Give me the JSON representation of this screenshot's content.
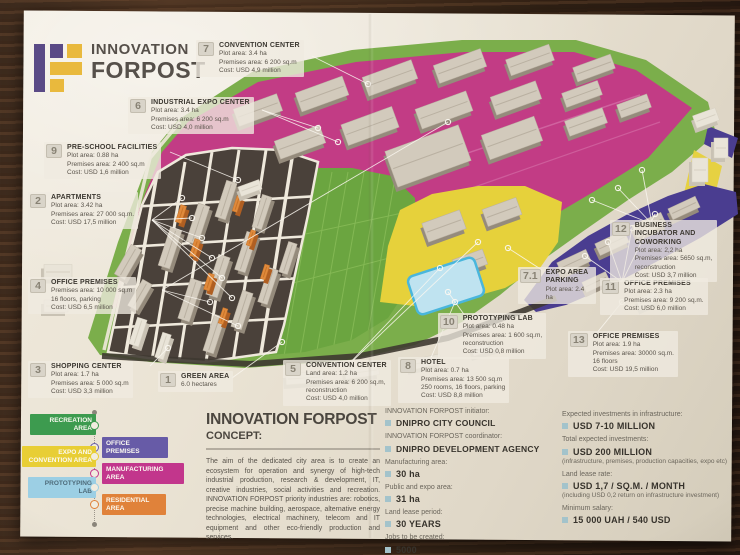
{
  "brand": {
    "line1": "INNOVATION",
    "line2": "FORPOST"
  },
  "map": {
    "labels": [
      {
        "num": "7",
        "title": "CONVENTION CENTER",
        "lines": [
          "Plot area: 3.4 ha",
          "Premises area: 6 200 sq.m",
          "Cost: USD 4,9 million"
        ]
      },
      {
        "num": "6",
        "title": "INDUSTRIAL EXPO CENTER",
        "lines": [
          "Plot area: 3.4 ha",
          "Premises area: 6 200 sq.m",
          "Cost: USD 4,0 million"
        ]
      },
      {
        "num": "9",
        "title": "PRE-SCHOOL FACILITIES",
        "lines": [
          "Plot area: 0.88 ha",
          "Premises area: 2 400 sq.m",
          "Cost: USD 1,6 million"
        ]
      },
      {
        "num": "2",
        "title": "APARTMENTS",
        "lines": [
          "Plot area: 3.42 ha",
          "Premises area: 27 000 sq.m.",
          "Cost: USD 17,5 million"
        ]
      },
      {
        "num": "4",
        "title": "OFFICE PREMISES",
        "lines": [
          "Premises area: 10 000 sq.m",
          "16 floors, parking",
          "Cost: USD 6,5 million"
        ]
      },
      {
        "num": "3",
        "title": "SHOPPING CENTER",
        "lines": [
          "Plot area: 1.7 ha",
          "Premises area: 5 000 sq.m",
          "Cost: USD 3,3 million"
        ]
      },
      {
        "num": "1",
        "title": "GREEN AREA",
        "lines": [
          "6.0 hectares"
        ]
      },
      {
        "num": "5",
        "title": "CONVENTION CENTER",
        "lines": [
          "Land area: 1.2 ha",
          "Premises area: 6 200 sq.m,",
          "reconstruction",
          "Cost: USD 4,0 million"
        ]
      },
      {
        "num": "8",
        "title": "HOTEL",
        "lines": [
          "Plot area: 0.7 ha",
          "Premises area: 13 500 sq.m",
          "250 rooms, 16 floors, parking",
          "Cost: USD 8,8 million"
        ]
      },
      {
        "num": "10",
        "title": "PROTOTYPING LAB",
        "lines": [
          "Plot area: 0.48 ha",
          "Premises area: 1 600 sq.m,",
          "reconstruction",
          "Cost: USD 0,8 million"
        ]
      },
      {
        "num": "7.1",
        "title": "EXPO AREA PARKING",
        "lines": [
          "Plot area: 2.4 ha"
        ]
      },
      {
        "num": "11",
        "title": "OFFICE PREMISES",
        "lines": [
          "Plot area: 2.3 ha",
          "Premises area: 9 200 sq.m.",
          "Cost: USD 6,0 million"
        ]
      },
      {
        "num": "12",
        "title": "BUSINESS INCUBATOR AND COWORKING",
        "lines": [
          "Plot area: 2,2 ha",
          "Premises area: 5650 sq.m,",
          "reconstruction",
          "Cost: USD 3,7 million"
        ]
      },
      {
        "num": "13",
        "title": "OFFICE PREMISES",
        "lines": [
          "Plot area: 1.9 ha",
          "Premises area: 30000 sq.m.",
          "16 floors",
          "Cost: USD 19,5 million"
        ]
      }
    ]
  },
  "legend": {
    "items": [
      {
        "label": "RECREATION AREA",
        "color": "#3d9b4f"
      },
      {
        "label": "OFFICE PREMISES",
        "color": "#675ba7"
      },
      {
        "label": "EXPO AND CONVENTION AREA",
        "color": "#e8ce35"
      },
      {
        "label": "MANUFACTURING AREA",
        "color": "#c2368c"
      },
      {
        "label": "PROTOTYPING LAB",
        "color": "#9ccfe4"
      },
      {
        "label": "RESIDENTIAL AREA",
        "color": "#e0823a"
      }
    ]
  },
  "concept": {
    "title": "INNOVATION FORPOST",
    "subtitle": "CONCEPT:",
    "body": "The aim of the dedicated city area is to create an ecosystem for operation and synergy of high-tech industrial production, research & development, IT, creative industries, social activities and recreation. INNOVATION FORPOST priority industries are: robotics, precise machine building, aerospace, alternative energy technologies, electrical machinery, telecom and IT equipment and other eco-friendly production and services."
  },
  "facts": {
    "items": [
      {
        "label": "INNOVATION FORPOST initiator:",
        "value": "DNIPRO CITY COUNCIL"
      },
      {
        "label": "INNOVATION FORPOST coordinator:",
        "value": "DNIPRO DEVELOPMENT AGENCY"
      },
      {
        "label": "Manufacturing area:",
        "value": "30 ha"
      },
      {
        "label": "Public and expo area:",
        "value": "31 ha"
      },
      {
        "label": "Land lease period:",
        "value": "30 YEARS"
      },
      {
        "label": "Jobs to be created:",
        "value": "5000"
      }
    ]
  },
  "investments": {
    "items": [
      {
        "label": "Expected investments in infrastructure:",
        "value": "USD 7-10 MILLION",
        "note": ""
      },
      {
        "label": "Total expected investments:",
        "value": "USD 200 MILLION",
        "note": "(infrastructure, premises, production capacities, expo etc)"
      },
      {
        "label": "Land lease rate:",
        "value": "USD 1,7 / SQ.M. / MONTH",
        "note": "(including USD 0,2 return on infrastructure investment)"
      },
      {
        "label": "Minimum salary:",
        "value": "15 000 UAH / 540 USD",
        "note": ""
      }
    ]
  },
  "colors": {
    "brand_purple": "#5a4a86",
    "brand_yellow": "#e9b93d",
    "manufacturing": "#c23c85",
    "recreation": "#7bae4b",
    "expo_yellow": "#e6d13b",
    "office_purple": "#4a3d90",
    "prototyping_cyan": "#9ccfe4",
    "residential_orange": "#d97a35",
    "paper": "#eae3d4",
    "wood": "#46301f"
  }
}
